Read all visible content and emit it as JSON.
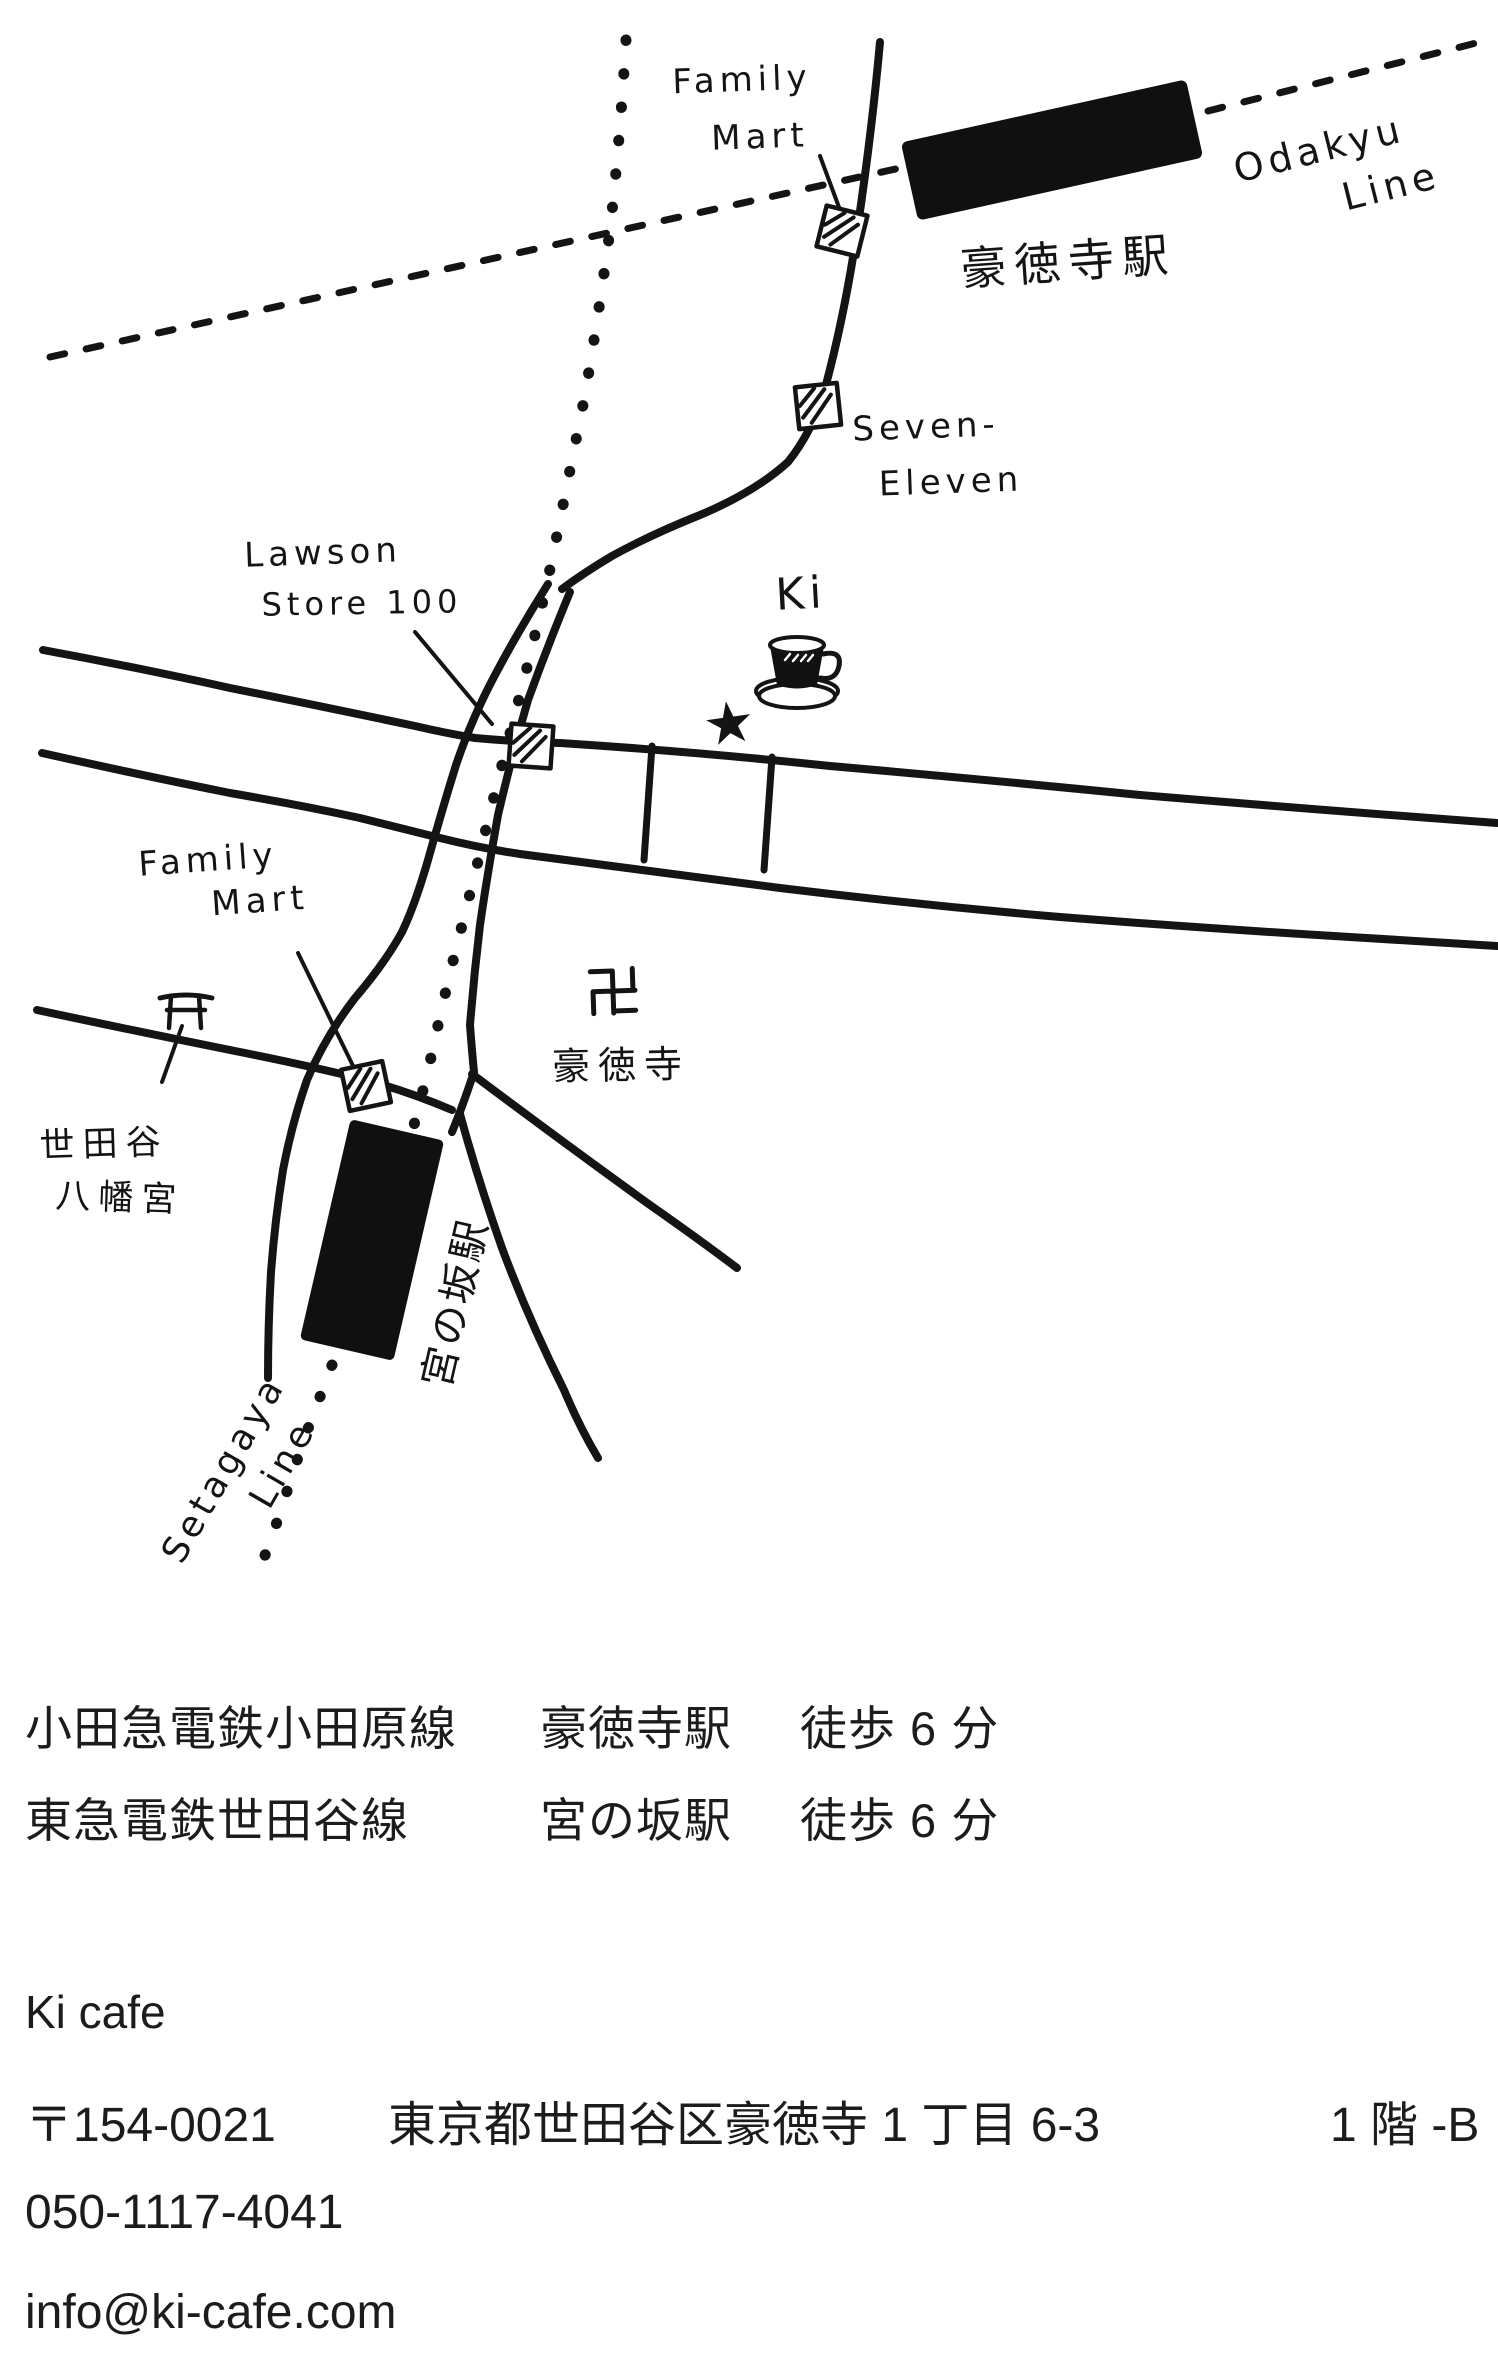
{
  "map": {
    "labels": {
      "family_mart_top": {
        "line1": "Family",
        "line2": "Mart"
      },
      "odakyu_line": {
        "line1": "Odakyu",
        "line2": "Line"
      },
      "gotokuji_station": "豪徳寺駅",
      "seven_eleven": {
        "line1": "Seven-",
        "line2": "Eleven"
      },
      "lawson": {
        "line1": "Lawson",
        "line2": "Store 100"
      },
      "cafe_name": "Ki",
      "cafe_star": "★",
      "gotokuji_temple": "豪徳寺",
      "family_mart_bottom": {
        "line1": "Family",
        "line2": "Mart"
      },
      "setagaya_hachimangu": {
        "line1": "世田谷",
        "line2": "八幡宮"
      },
      "miyanosaka_station": "宮の坂駅",
      "setagaya_line": {
        "line1": "Setagaya",
        "line2": "Line"
      }
    }
  },
  "access": [
    {
      "railway": "小田急電鉄小田原線",
      "station": "豪徳寺駅",
      "walk": "徒歩 6 分"
    },
    {
      "railway": "東急電鉄世田谷線",
      "station": "宮の坂駅",
      "walk": "徒歩 6 分"
    }
  ],
  "contact": {
    "name": "Ki cafe",
    "postal_code": "〒154-0021",
    "address": "東京都世田谷区豪徳寺 1 丁目 6-3",
    "unit": "1 階 -B",
    "phone": "050-1117-4041",
    "email": "info@ki-cafe.com"
  },
  "colors": {
    "ink": "#141414",
    "background": "#ffffff"
  }
}
